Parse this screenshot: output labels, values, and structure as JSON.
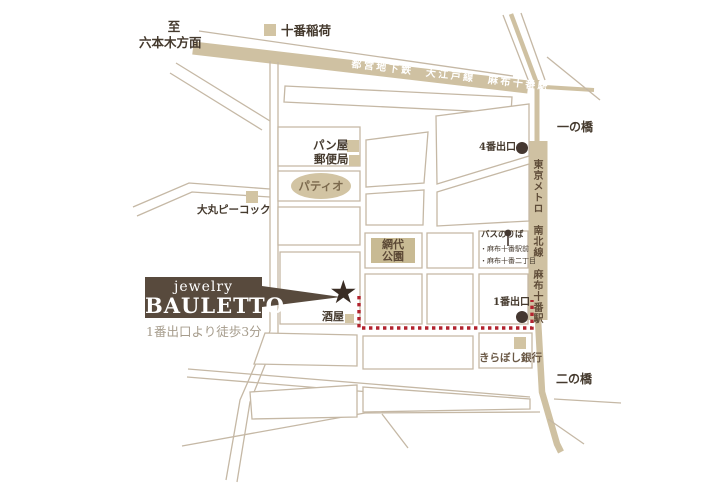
{
  "map": {
    "labels": {
      "to": "至",
      "roppongi_direction": "六本木方面",
      "juban_inari": "十番稲荷",
      "oedo_line": "都営地下鉄　大江戸線　麻布十番駅",
      "namboku_line": "東京メトロ　南北線　麻布十番駅",
      "ichinohashi": "一の橋",
      "ninohashi": "二の橋",
      "bakery": "パン屋",
      "post_office": "郵便局",
      "patio": "パティオ",
      "daimaru_peacock": "大丸ピーコック",
      "ajiro_park_line1": "網代",
      "ajiro_park_line2": "公園",
      "exit4": "4番出口",
      "exit1": "1番出口",
      "bus_stop_title": "バスのりば",
      "bus_stops": [
        "・麻布十番駅前",
        "・麻布十番二丁目"
      ],
      "sakaya": "酒屋",
      "kiraboshi_bank": "きらぼし銀行"
    },
    "logo": {
      "brand_top": "jewelry",
      "brand_name": "BAULETTO",
      "access_note": "1番出口より徒歩3分",
      "star_icon": "★"
    },
    "colors": {
      "road_tan": "#cfc1a2",
      "street_line": "#c5b8a5",
      "marker_tan": "#d2c4a3",
      "park_fill": "#c8ba93",
      "exit_dot_brown": "#443730",
      "logo_brown": "#584a3d",
      "route_red": "#b2232e",
      "label_text": "#453a2e"
    }
  }
}
